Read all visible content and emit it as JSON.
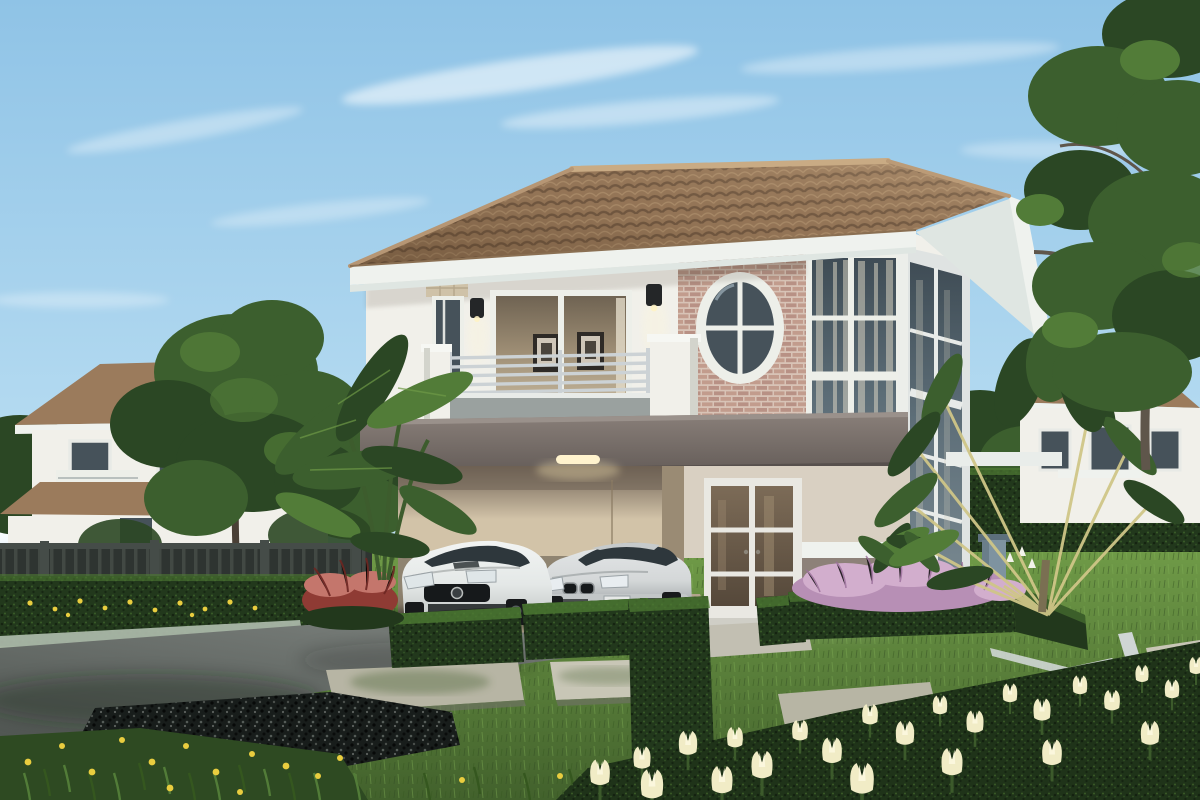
{
  "meta": {
    "kind": "architectural-rendering",
    "subject": "Two-story modern tropical house with carport, two parked cars and landscaped garden",
    "daytime": "clear blue sky with wispy clouds"
  },
  "palette": {
    "sky_top": "#8fc3e6",
    "sky_mid": "#b5dbf1",
    "sky_low": "#e4f1f8",
    "cloud": "#ffffff",
    "roof_base": "#9b7b5c",
    "roof_dark": "#6e563f",
    "roof_light": "#c3a47e",
    "ridge": "#c9ab84",
    "fascia": "#eff2ee",
    "soffit": "#dfe6e2",
    "wall_white": "#f1f0ea",
    "wall_shade": "#d8d8d0",
    "frame_white": "#edefe9",
    "brick": "#c29c8d",
    "brick_alt": "#b89185",
    "mortar": "#d8c3b6",
    "band_top": "#8a807a",
    "band_bottom": "#645c58",
    "glass_dark": "#46525a",
    "glass_mid": "#5d6e78",
    "curtain": "#e3dcc9",
    "interior_warm": "#cdbfa4",
    "interior_deep": "#6f6352",
    "door_glass": "#6d5c49",
    "post": "#675e59",
    "post_dark": "#4c4540",
    "balcony_panel": "#9aa19f",
    "rail": "#ccd2d5",
    "carport_wall": "#d2c3a8",
    "carport_shadow": "#6e6154",
    "cream_wall": "#d9d0c2",
    "taupe_lower": "#8d8179",
    "car_white": "#f2f4f3",
    "car_white_shade": "#c7cbca",
    "car_silver": "#d4d7d8",
    "car_silver_shade": "#9da2a4",
    "car_glass": "#2e373c",
    "grille_dark": "#16191b",
    "tree_deep": "#2b4724",
    "tree_mid": "#3c5f2e",
    "tree_light": "#527c38",
    "hedge_deep": "#22381c",
    "hedge_lit": "#4e7a33",
    "lawn_light": "#6f9a47",
    "lawn_deep": "#42612c",
    "purple": "#b78fb5",
    "purple_light": "#d2aecd",
    "red_plant": "#8f3b34",
    "red_plant_light": "#c4766c",
    "paver": "#b7b5a4",
    "paver_light": "#c8c6b6",
    "edging": "#cfd6d4",
    "drive_light": "#8b908c",
    "drive_dark": "#4e5450",
    "curb": "#aab7a8",
    "gravel": "#181d1b",
    "flower_yellow": "#e9cd3f",
    "flower_cream": "#f1ecc6",
    "fence": "#2e3431",
    "fence_light": "#454c48",
    "trunk": "#5f564b",
    "pillar_blue": "#7e93a0",
    "lamp_black": "#242628",
    "lamp_glow": "#fff6d8"
  },
  "scene": {
    "background": [
      "neighbor house left",
      "neighbor house right",
      "trees",
      "perimeter fence with hedge"
    ],
    "main_house": [
      "hip tile roof",
      "brick accent wall with oval window",
      "balcony with steel rails",
      "double-height corner glass tower",
      "carport with ceiling light",
      "french entry door",
      "wall lamps"
    ],
    "vehicles": [
      {
        "name": "white sports car",
        "position": "carport left"
      },
      {
        "name": "silver sedan",
        "position": "carport right"
      }
    ],
    "garden": [
      "trimmed box hedges",
      "purple fountain grass bed",
      "red cordyline",
      "banana plants",
      "travelers palm",
      "stepping stone pavers",
      "white lawn edging",
      "black gravel bed",
      "yellow flowers",
      "cream tulip bed"
    ]
  }
}
